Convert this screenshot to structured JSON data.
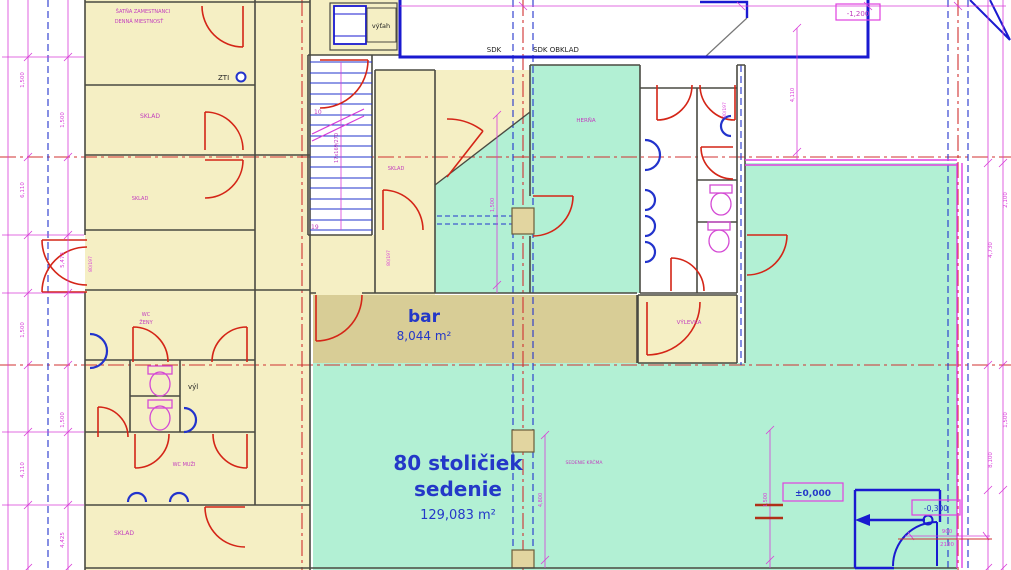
{
  "colors": {
    "room_yellow": "#f5efc4",
    "bar_tan": "#d8cd96",
    "seating_teal": "#b2f0d4",
    "wall_dark": "#4a4a42",
    "wall_blue": "#1a1ad0",
    "door_red": "#d42517",
    "dim_magenta": "#d83cd8",
    "axis_red": "#d03030",
    "label_blue": "#2438c8",
    "label_magenta": "#c23cbe"
  },
  "rooms": {
    "satna1": "ŠATŇA ZAMESTNANCI",
    "satna2": "DENNÁ MIESTNOSŤ",
    "sklad": "SKLAD",
    "sklad2": "SKLAD",
    "sklad3": "SKLAD",
    "sklad4": "SKLAD",
    "wc_zeny1": "WC",
    "wc_zeny2": "ŽENY",
    "wc_muzi": "WC MUŽI",
    "vyl": "výl",
    "vytah": "výťah",
    "zti": "ZTI",
    "herna": "HERŇA",
    "vylevka": "VÝLEVKA",
    "sedenie_note": "SEDENIE KRČMA"
  },
  "labels": {
    "bar_name": "bar",
    "bar_area": "8,044 m²",
    "seat1": "80 stoličiek",
    "seat2": "sedenie",
    "seat_area": "129,083 m²",
    "sdk": "SDK",
    "sdk_obklad": "SDK OBKLAD",
    "level_zero": "±0,000",
    "level_minus": "-0,300",
    "level_top": "-1,200",
    "door_w": "900",
    "door_h": "2100",
    "stair_spec": "17x169/270",
    "stair_top": "10",
    "stair_bottom": "19",
    "door_tag": "80/197"
  },
  "dims": {
    "d1": "1,500",
    "d2": "6,110",
    "d3": "1,500",
    "d4": "4,110",
    "d5": "1,500",
    "d6": "5,473",
    "d7": "1,500",
    "d8": "4,425",
    "d9": "4,730",
    "d10": "8,100",
    "d11": "2,100",
    "d12": "1,500",
    "d13": "4,800"
  }
}
